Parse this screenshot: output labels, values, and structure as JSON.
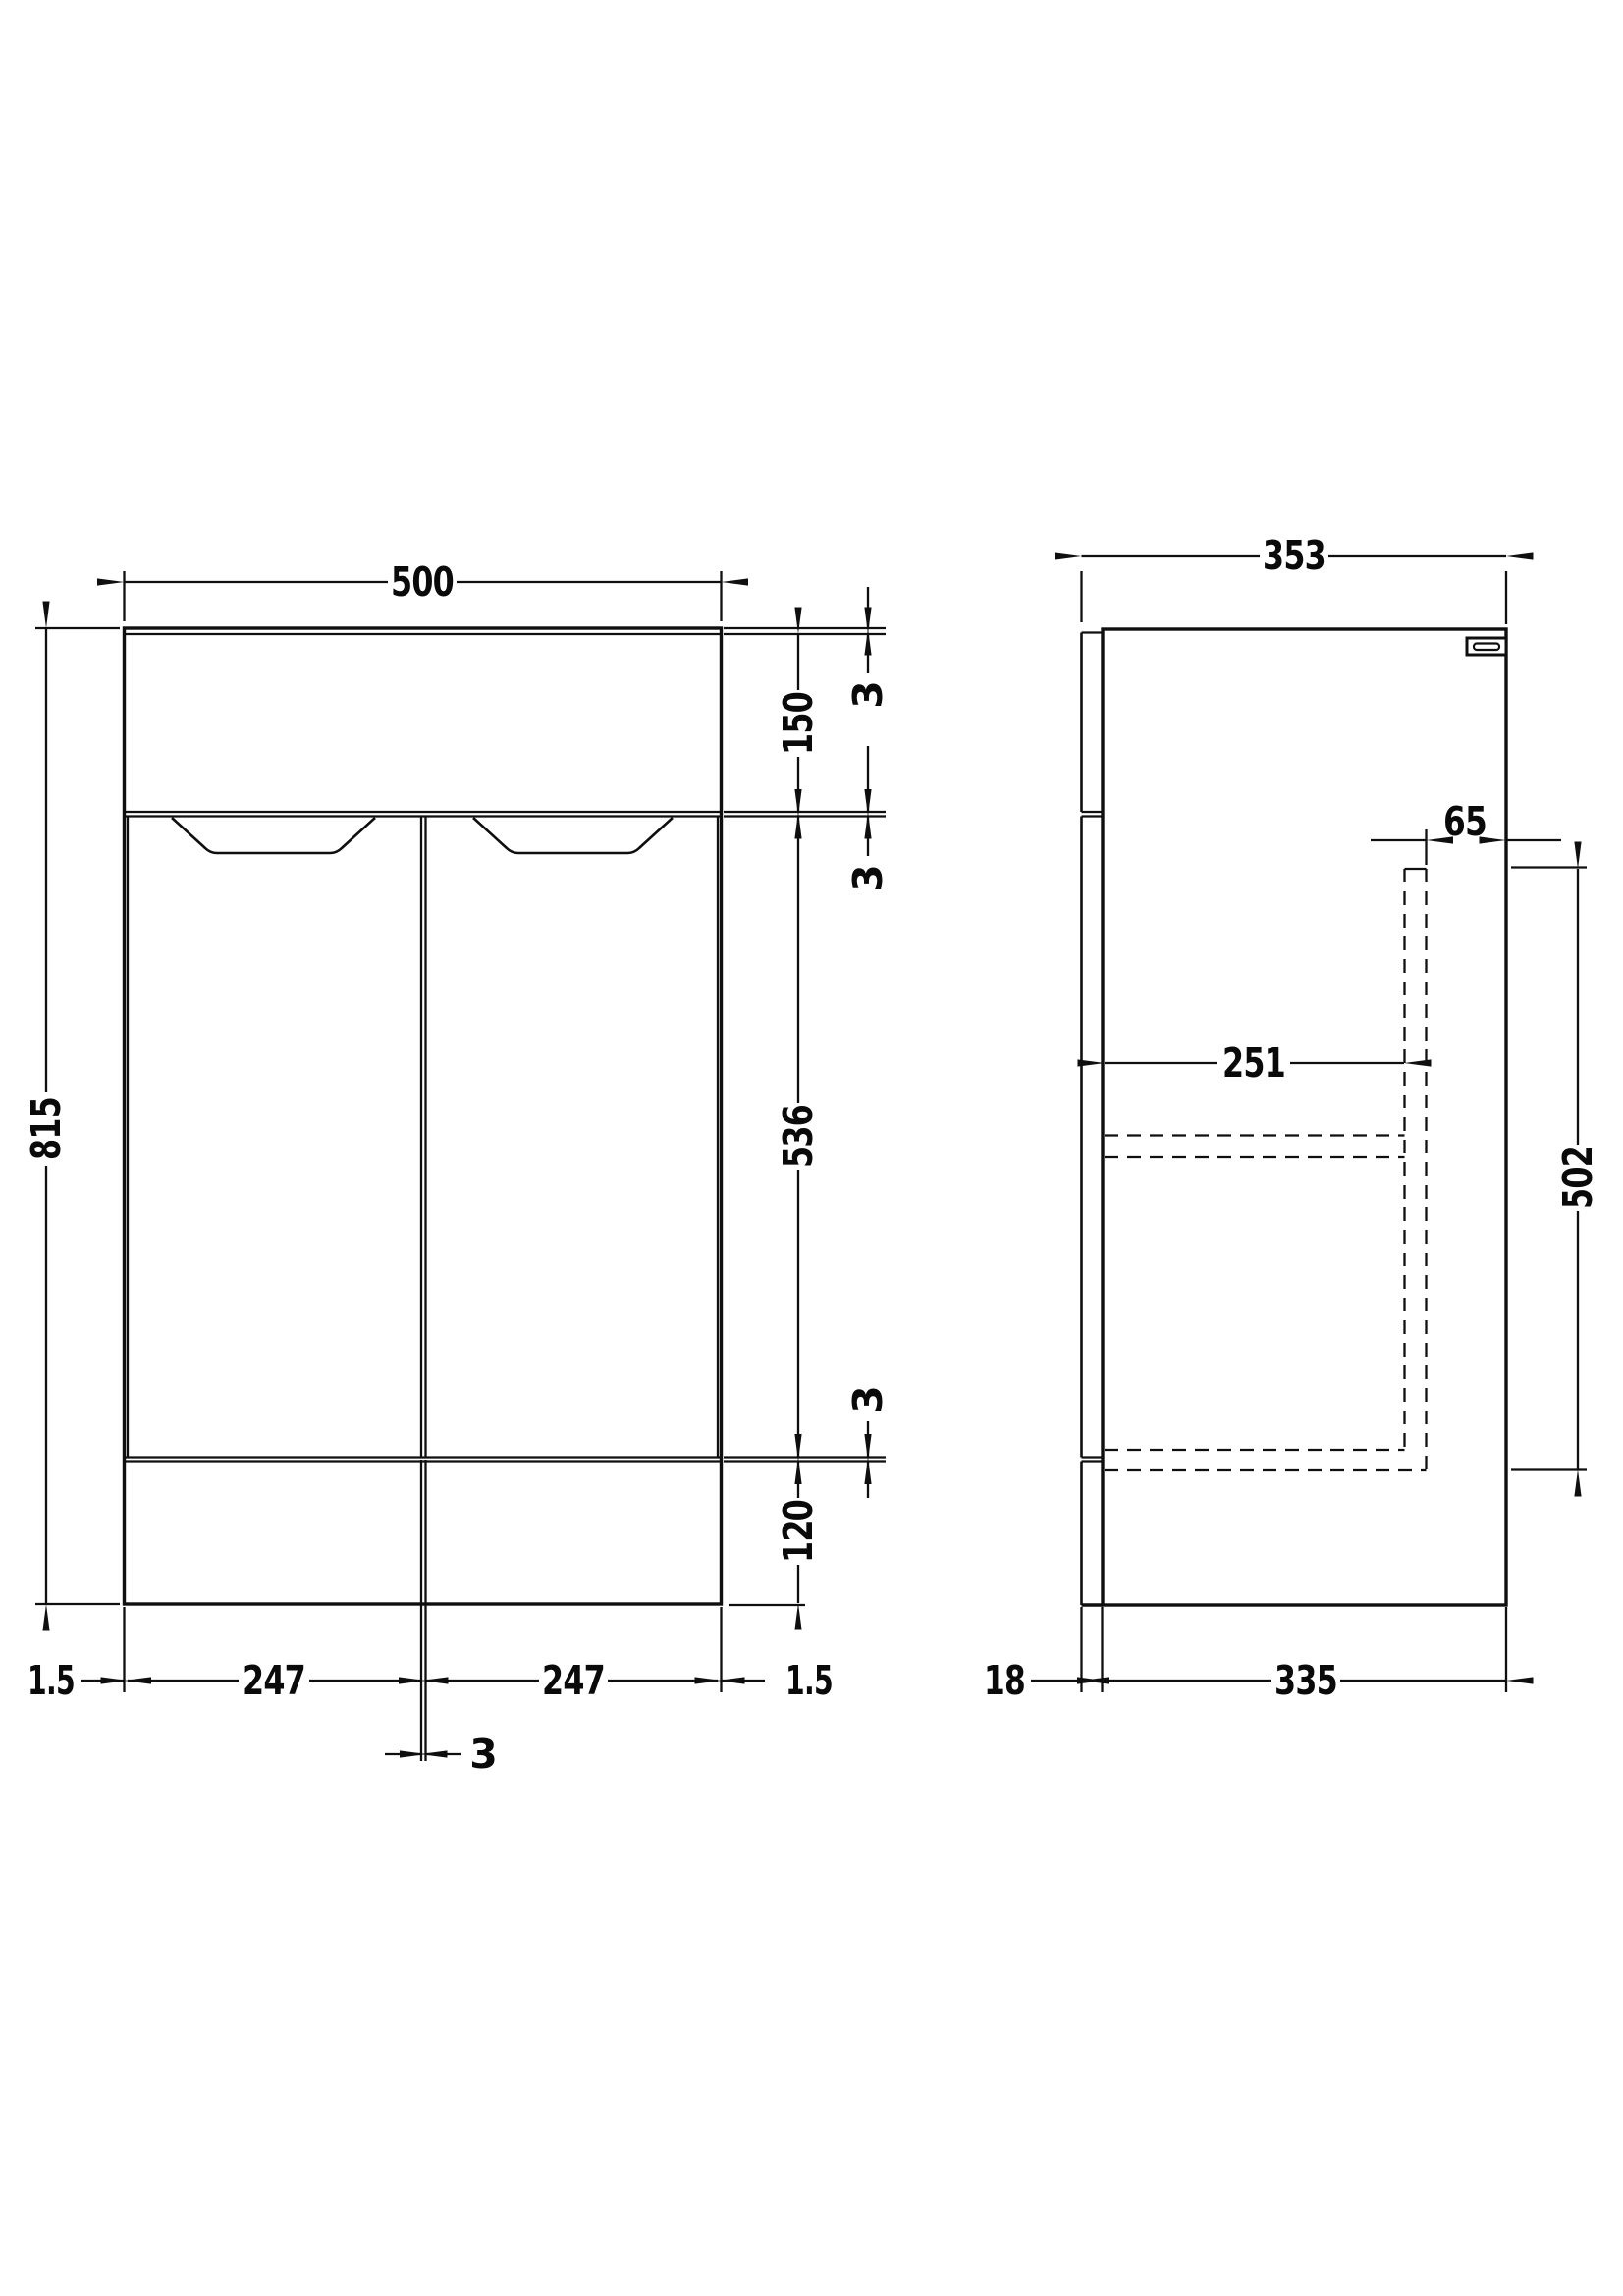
{
  "drawing": {
    "colors": {
      "background": "#ffffff",
      "line": "#0f0f0f",
      "text": "#0a0a0a"
    },
    "front_view": {
      "overall_width": "500",
      "overall_height": "815",
      "top_panel_height": "150",
      "door_height": "536",
      "plinth_height": "120",
      "gap_top": "3",
      "gap_middle": "3",
      "gap_bottom": "3",
      "left_door_width": "247",
      "right_door_width": "247",
      "left_edge_gap": "1.5",
      "right_edge_gap": "1.5",
      "center_door_gap": "3"
    },
    "side_view": {
      "overall_depth": "353",
      "internal_depth": "251",
      "void_offset": "65",
      "internal_height": "502",
      "door_thickness": "18",
      "carcass_depth": "335"
    }
  }
}
